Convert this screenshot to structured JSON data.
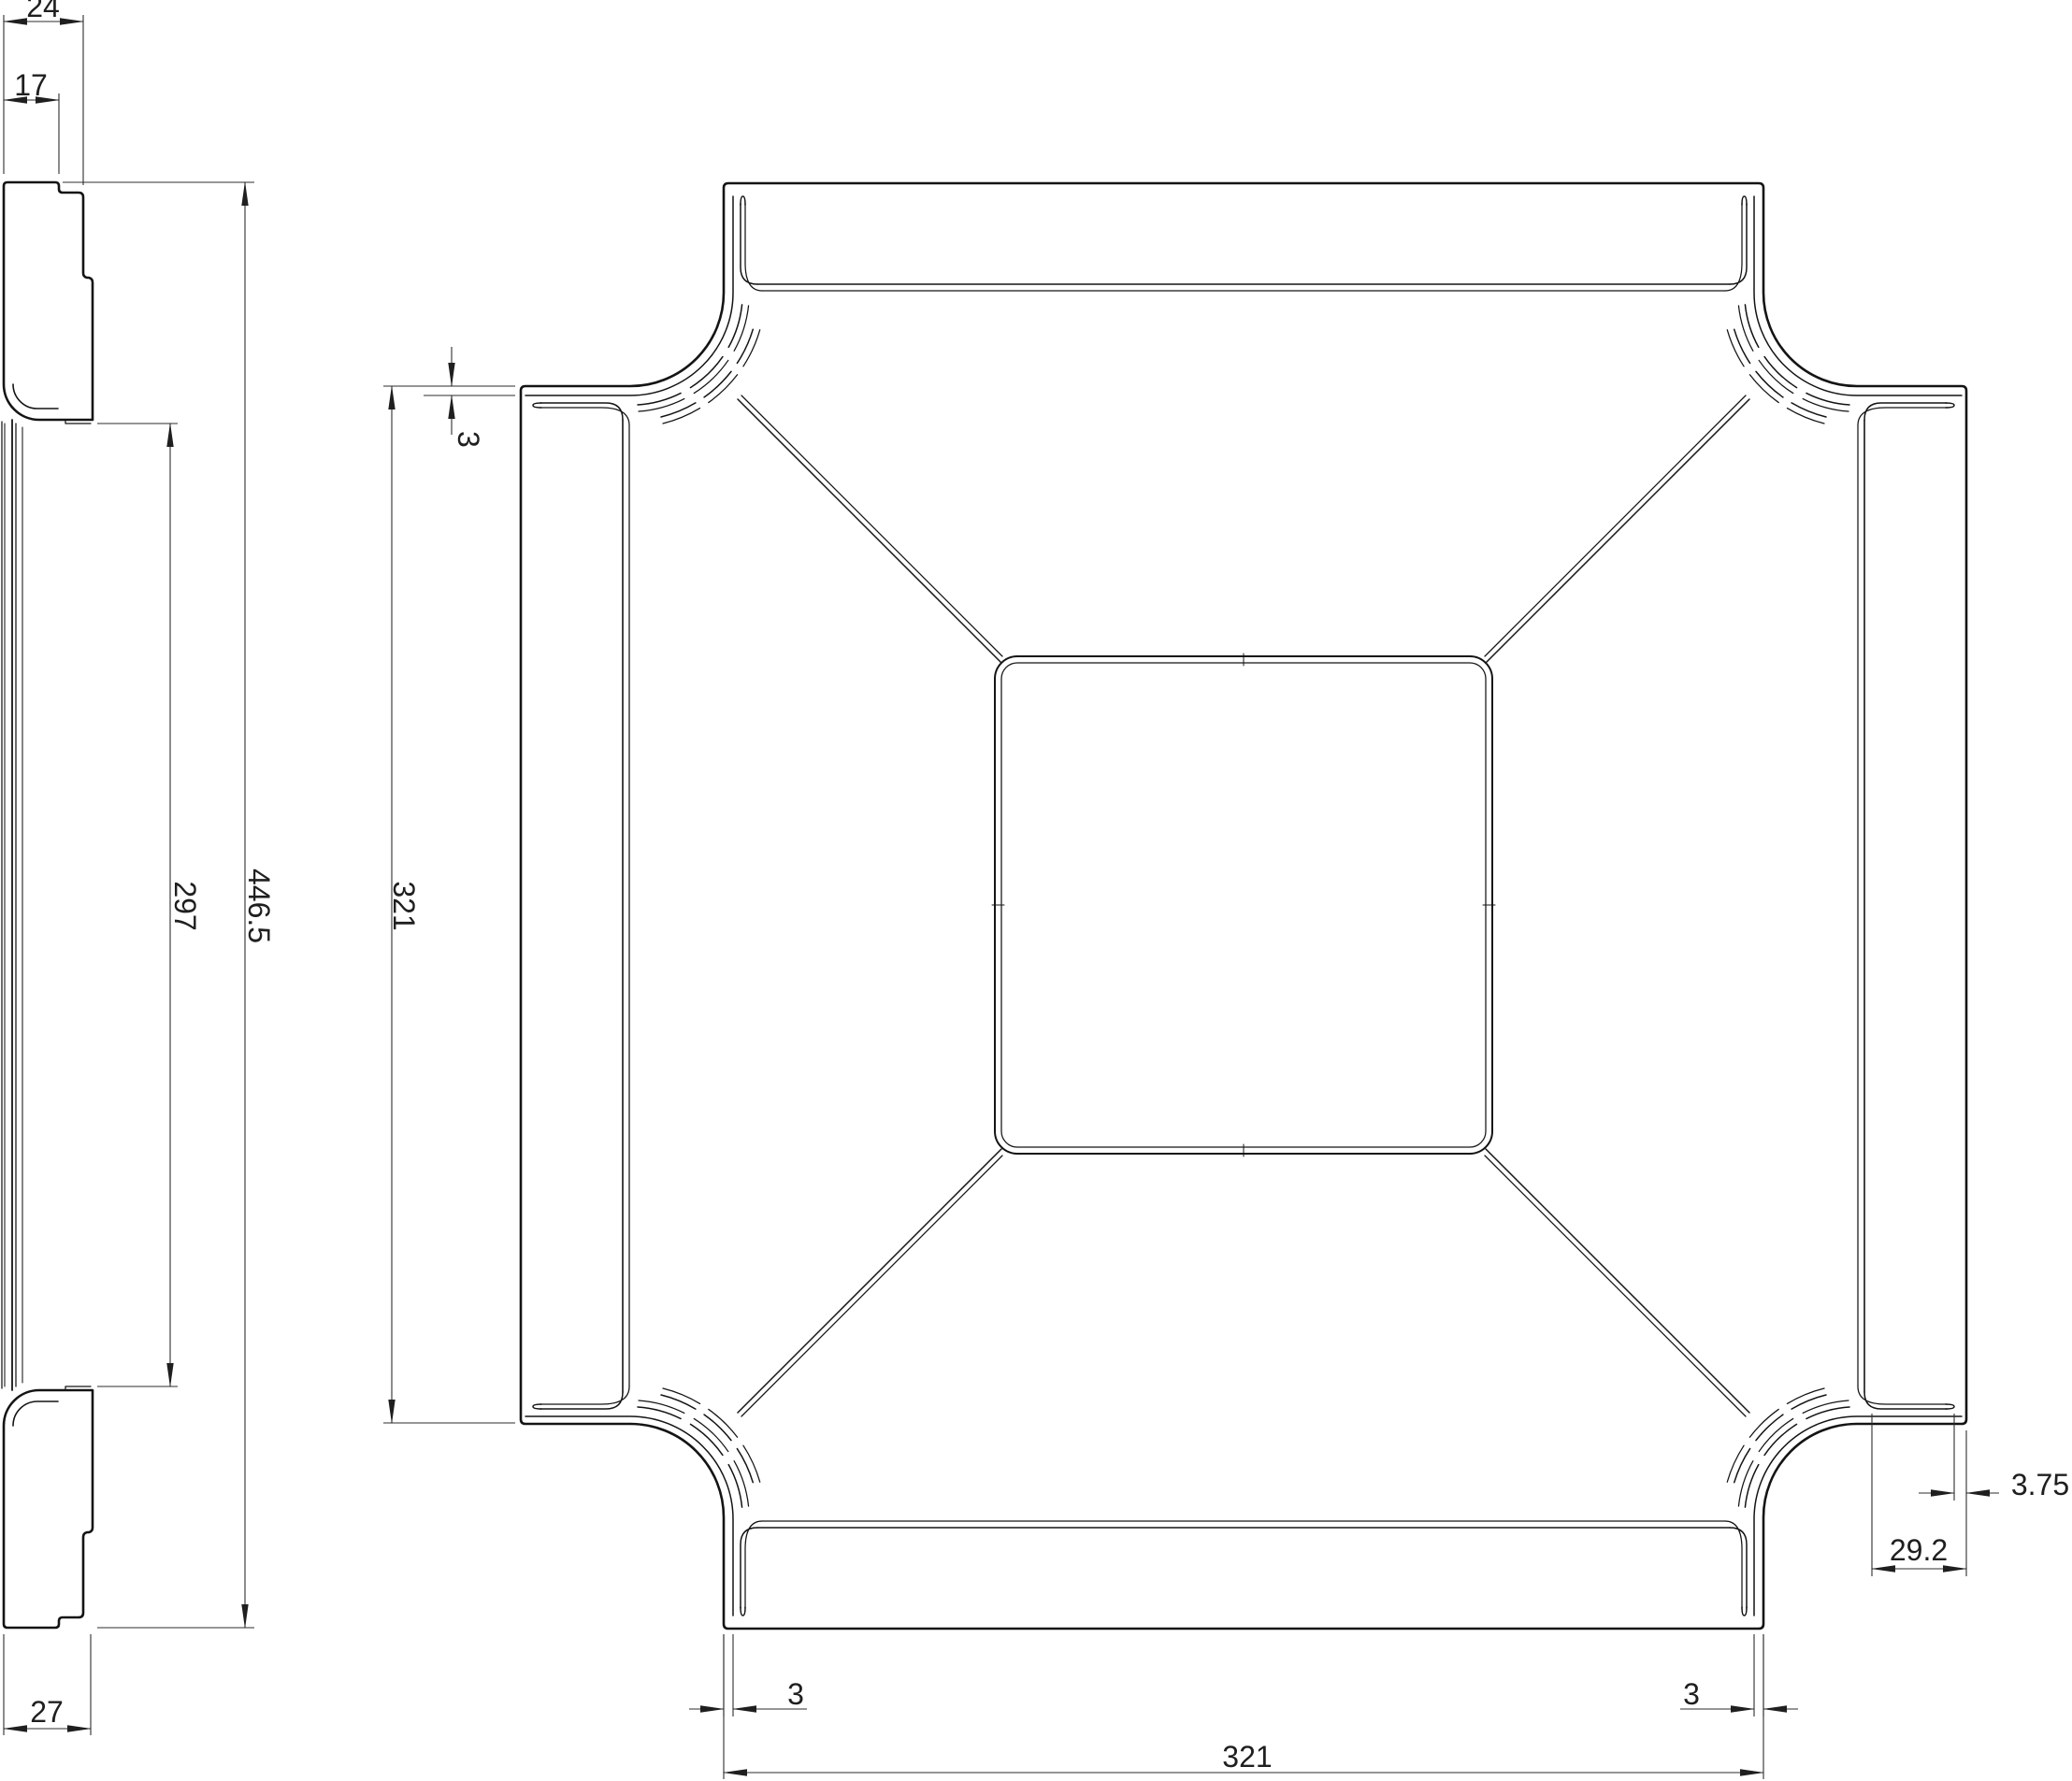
{
  "drawing": {
    "kind": "cad-technical-drawing",
    "background": "#ffffff",
    "line_color": "#141414",
    "dim_color": "#2e2e2e",
    "views": {
      "side_view": {
        "dimensions": {
          "flange_width": "24",
          "rim_width": "17",
          "inner_height": "297",
          "overall_height": "446.5",
          "depth": "27"
        }
      },
      "plan_view": {
        "dimensions": {
          "wall_thickness_top": "3",
          "side_length_left": "321",
          "flange_gap": "3.75",
          "flange_width": "29.2",
          "wall_thickness_bottom_left": "3",
          "wall_thickness_bottom_right": "3",
          "side_length_bottom": "321"
        }
      }
    }
  }
}
